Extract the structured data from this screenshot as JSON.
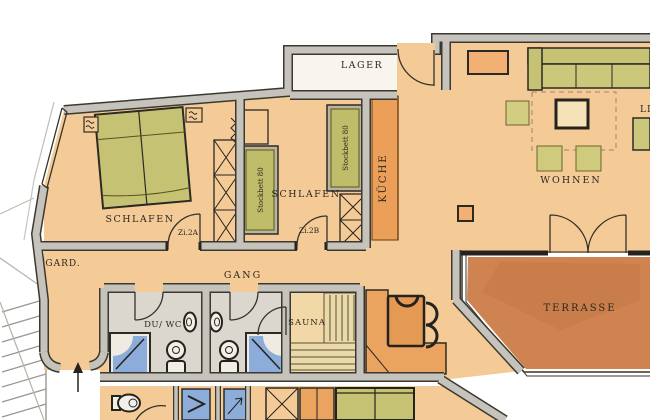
{
  "plan": {
    "rooms": {
      "schlafen_left": "SCHLAFEN",
      "schlafen_middle": "SCHLAFEN",
      "lager": "LAGER",
      "kueche": "KÜCHE",
      "wohnen": "WOHNEN",
      "terrasse": "TERRASSE",
      "gang": "GANG",
      "garderobe": "GARD.",
      "du_wc": "DU/ WC",
      "sauna": "SAUNA",
      "liege_clipped": "LI"
    },
    "door_labels": {
      "zi2a": "Zi.2A",
      "zi2b": "Zi.2B"
    },
    "furniture_labels": {
      "stockbett_left": "Stockbett 80",
      "stockbett_right": "Stockbett 80"
    },
    "palette": {
      "floor_peach": "#f4cb96",
      "wall_gray": "#c6c3bc",
      "outline_dark": "#3b382f",
      "furniture_green": "#c6c273",
      "kitchen_orange": "#eb9f58",
      "terrace_brown": "#cf8350",
      "shower_blue": "#8cadd9",
      "sauna_bench_tan": "#ead9a9",
      "lager_white": "#f8f5ef"
    }
  }
}
